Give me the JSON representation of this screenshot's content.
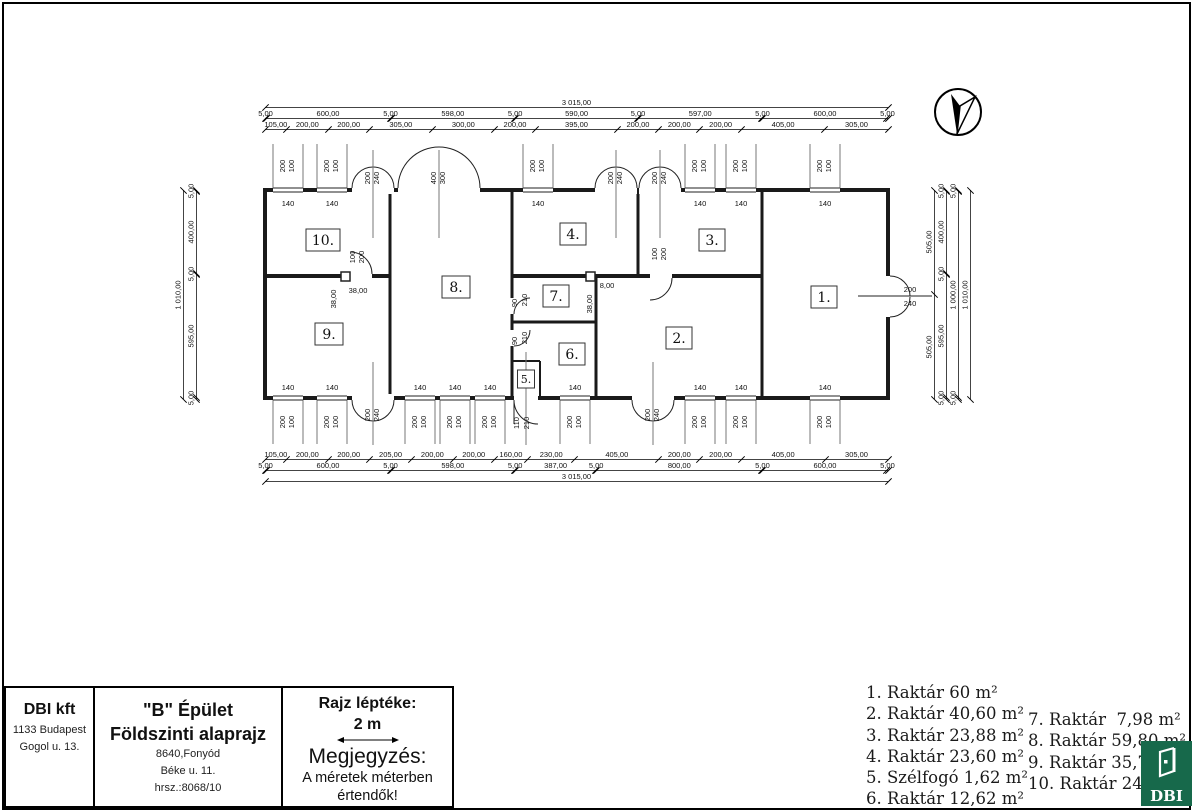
{
  "title_block": {
    "company": "DBI kft",
    "company_addr1": "1133 Budapest",
    "company_addr2": "Gogol u. 13.",
    "building": "\"B\" Épület",
    "drawing": "Földszinti alaprajz",
    "site1": "8640,Fonyód",
    "site2": "Béke u. 11.",
    "site3": "hrsz.:8068/10",
    "scale_title": "Rajz léptéke:",
    "scale_value": "2 m",
    "note_title": "Megjegyzés:",
    "note_line1": "A méretek méterben",
    "note_line2": "értendők!"
  },
  "legend": {
    "col1": [
      "1. Raktár 60 m²",
      "2. Raktár 40,60 m²",
      "3. Raktár 23,88 m²",
      "4. Raktár 23,60 m²",
      "5. Szélfogó 1,62 m²",
      "6. Raktár 12,62 m²"
    ],
    "col2": [
      "7. Raktár  7,98 m²",
      "8. Raktár 59,80 m²",
      "9. Raktár 35,7",
      "10. Raktár 24"
    ]
  },
  "logo": {
    "text": "DBI",
    "green": "#17694b"
  },
  "dims": [
    {
      "o": "h",
      "x": 265,
      "y": 97,
      "len": 623,
      "segs": [
        [
          3015,
          "3 015,00"
        ]
      ]
    },
    {
      "o": "h",
      "x": 265,
      "y": 108,
      "len": 623,
      "segs": [
        [
          5,
          "5,00"
        ],
        [
          600,
          "600,00"
        ],
        [
          5,
          "5,00"
        ],
        [
          598,
          "598,00"
        ],
        [
          5,
          "5,00"
        ],
        [
          590,
          "590,00"
        ],
        [
          5,
          "5,00"
        ],
        [
          597,
          "597,00"
        ],
        [
          5,
          "5,00"
        ],
        [
          600,
          "600,00"
        ],
        [
          5,
          "5,00"
        ]
      ]
    },
    {
      "o": "h",
      "x": 265,
      "y": 119,
      "len": 623,
      "segs": [
        [
          105,
          "105,00"
        ],
        [
          200,
          "200,00"
        ],
        [
          200,
          "200,00"
        ],
        [
          305,
          "305,00"
        ],
        [
          300,
          "300,00"
        ],
        [
          200,
          "200,00"
        ],
        [
          395,
          "395,00"
        ],
        [
          200,
          "200,00"
        ],
        [
          200,
          "200,00"
        ],
        [
          200,
          "200,00"
        ],
        [
          405,
          "405,00"
        ],
        [
          305,
          "305,00"
        ]
      ]
    },
    {
      "o": "h",
      "x": 265,
      "y": 449,
      "len": 623,
      "segs": [
        [
          105,
          "105,00"
        ],
        [
          200,
          "200,00"
        ],
        [
          200,
          "200,00"
        ],
        [
          205,
          "205,00"
        ],
        [
          200,
          "200,00"
        ],
        [
          200,
          "200,00"
        ],
        [
          160,
          "160,00"
        ],
        [
          230,
          "230,00"
        ],
        [
          405,
          "405,00"
        ],
        [
          200,
          "200,00"
        ],
        [
          200,
          "200,00"
        ],
        [
          405,
          "405,00"
        ],
        [
          305,
          "305,00"
        ]
      ]
    },
    {
      "o": "h",
      "x": 265,
      "y": 460,
      "len": 623,
      "segs": [
        [
          5,
          "5,00"
        ],
        [
          600,
          "600,00"
        ],
        [
          5,
          "5,00"
        ],
        [
          598,
          "598,00"
        ],
        [
          5,
          "5,00"
        ],
        [
          387,
          "387,00"
        ],
        [
          5,
          "5,00"
        ],
        [
          800,
          "800,00"
        ],
        [
          5,
          "5,00"
        ],
        [
          600,
          "600,00"
        ],
        [
          5,
          "5,00"
        ]
      ]
    },
    {
      "o": "h",
      "x": 265,
      "y": 471,
      "len": 623,
      "segs": [
        [
          3015,
          "3 015,00"
        ]
      ]
    },
    {
      "o": "v",
      "x": 183,
      "y": 190,
      "len": 209,
      "segs": [
        [
          1010,
          "1 010,00"
        ]
      ]
    },
    {
      "o": "v",
      "x": 196,
      "y": 190,
      "len": 209,
      "segs": [
        [
          5,
          "5,00"
        ],
        [
          400,
          "400,00"
        ],
        [
          5,
          "5,00"
        ],
        [
          595,
          "595,00"
        ],
        [
          5,
          "5,00"
        ]
      ]
    },
    {
      "o": "v",
      "x": 934,
      "y": 190,
      "len": 209,
      "segs": [
        [
          505,
          "505,00"
        ],
        [
          505,
          "505,00"
        ]
      ]
    },
    {
      "o": "v",
      "x": 946,
      "y": 190,
      "len": 209,
      "segs": [
        [
          5,
          "5,00"
        ],
        [
          400,
          "400,00"
        ],
        [
          5,
          "5,00"
        ],
        [
          595,
          "595,00"
        ],
        [
          5,
          "5,00"
        ]
      ]
    },
    {
      "o": "v",
      "x": 958,
      "y": 190,
      "len": 209,
      "segs": [
        [
          5,
          "5,00"
        ],
        [
          1000,
          "1 000,00"
        ],
        [
          5,
          "5,00"
        ]
      ]
    },
    {
      "o": "v",
      "x": 970,
      "y": 190,
      "len": 209,
      "segs": [
        [
          1010,
          "1 010,00"
        ]
      ]
    }
  ],
  "plan": {
    "window_width_label": "140",
    "window_pair": [
      "200",
      "100"
    ],
    "windows_top": [
      288,
      332,
      538,
      700,
      741,
      825
    ],
    "windows_bottom": [
      288,
      332,
      420,
      455,
      490,
      575,
      700,
      741,
      825
    ],
    "doors_top": [
      {
        "cx": 373,
        "hw": 21,
        "pair": [
          "200",
          "240"
        ]
      },
      {
        "cx": 439,
        "hw": 41,
        "pair": [
          "400",
          "300"
        ]
      },
      {
        "cx": 616,
        "hw": 21,
        "pair": [
          "200",
          "240"
        ]
      },
      {
        "cx": 660,
        "hw": 21,
        "pair": [
          "200",
          "240"
        ]
      }
    ],
    "doors_bottom": [
      {
        "cx": 373,
        "hw": 21,
        "pair": [
          "200",
          "240"
        ]
      },
      {
        "cx": 653,
        "hw": 21,
        "pair": [
          "200",
          "240"
        ]
      }
    ],
    "rooms": [
      {
        "label": "10.",
        "x": 323,
        "y": 240,
        "w": 34
      },
      {
        "label": "9.",
        "x": 329,
        "y": 334,
        "w": 28
      },
      {
        "label": "8.",
        "x": 456,
        "y": 287,
        "w": 28
      },
      {
        "label": "7.",
        "x": 556,
        "y": 296,
        "w": 26
      },
      {
        "label": "6.",
        "x": 572,
        "y": 354,
        "w": 26
      },
      {
        "label": "5.",
        "x": 526,
        "y": 379,
        "w": 17,
        "h": 18,
        "fs": 11
      },
      {
        "label": "4.",
        "x": 573,
        "y": 234,
        "w": 26
      },
      {
        "label": "3.",
        "x": 712,
        "y": 240,
        "w": 26
      },
      {
        "label": "2.",
        "x": 679,
        "y": 338,
        "w": 26
      },
      {
        "label": "1.",
        "x": 824,
        "y": 297,
        "w": 26
      }
    ],
    "annotations": [
      {
        "t": "38,00",
        "x": 336,
        "y": 299,
        "r": -90
      },
      {
        "t": "38,00",
        "x": 358,
        "y": 293,
        "r": 0
      },
      {
        "t": "38,00",
        "x": 592,
        "y": 304,
        "r": -90
      },
      {
        "t": "8,00",
        "x": 607,
        "y": 288,
        "r": 0
      },
      {
        "t": "100",
        "x": 355,
        "y": 257,
        "r": -90
      },
      {
        "t": "200",
        "x": 364,
        "y": 257,
        "r": -90
      },
      {
        "t": "100",
        "x": 657,
        "y": 254,
        "r": -90
      },
      {
        "t": "200",
        "x": 666,
        "y": 254,
        "r": -90
      },
      {
        "t": "90",
        "x": 517,
        "y": 303,
        "r": -90
      },
      {
        "t": "210",
        "x": 527,
        "y": 300,
        "r": -90
      },
      {
        "t": "90",
        "x": 517,
        "y": 341,
        "r": -90
      },
      {
        "t": "210",
        "x": 527,
        "y": 338,
        "r": -90
      },
      {
        "t": "110",
        "x": 519,
        "y": 423,
        "r": -90
      },
      {
        "t": "210",
        "x": 529,
        "y": 423,
        "r": -90
      },
      {
        "t": "200",
        "x": 910,
        "y": 292,
        "r": 0
      },
      {
        "t": "240",
        "x": 910,
        "y": 306,
        "r": 0
      }
    ]
  }
}
